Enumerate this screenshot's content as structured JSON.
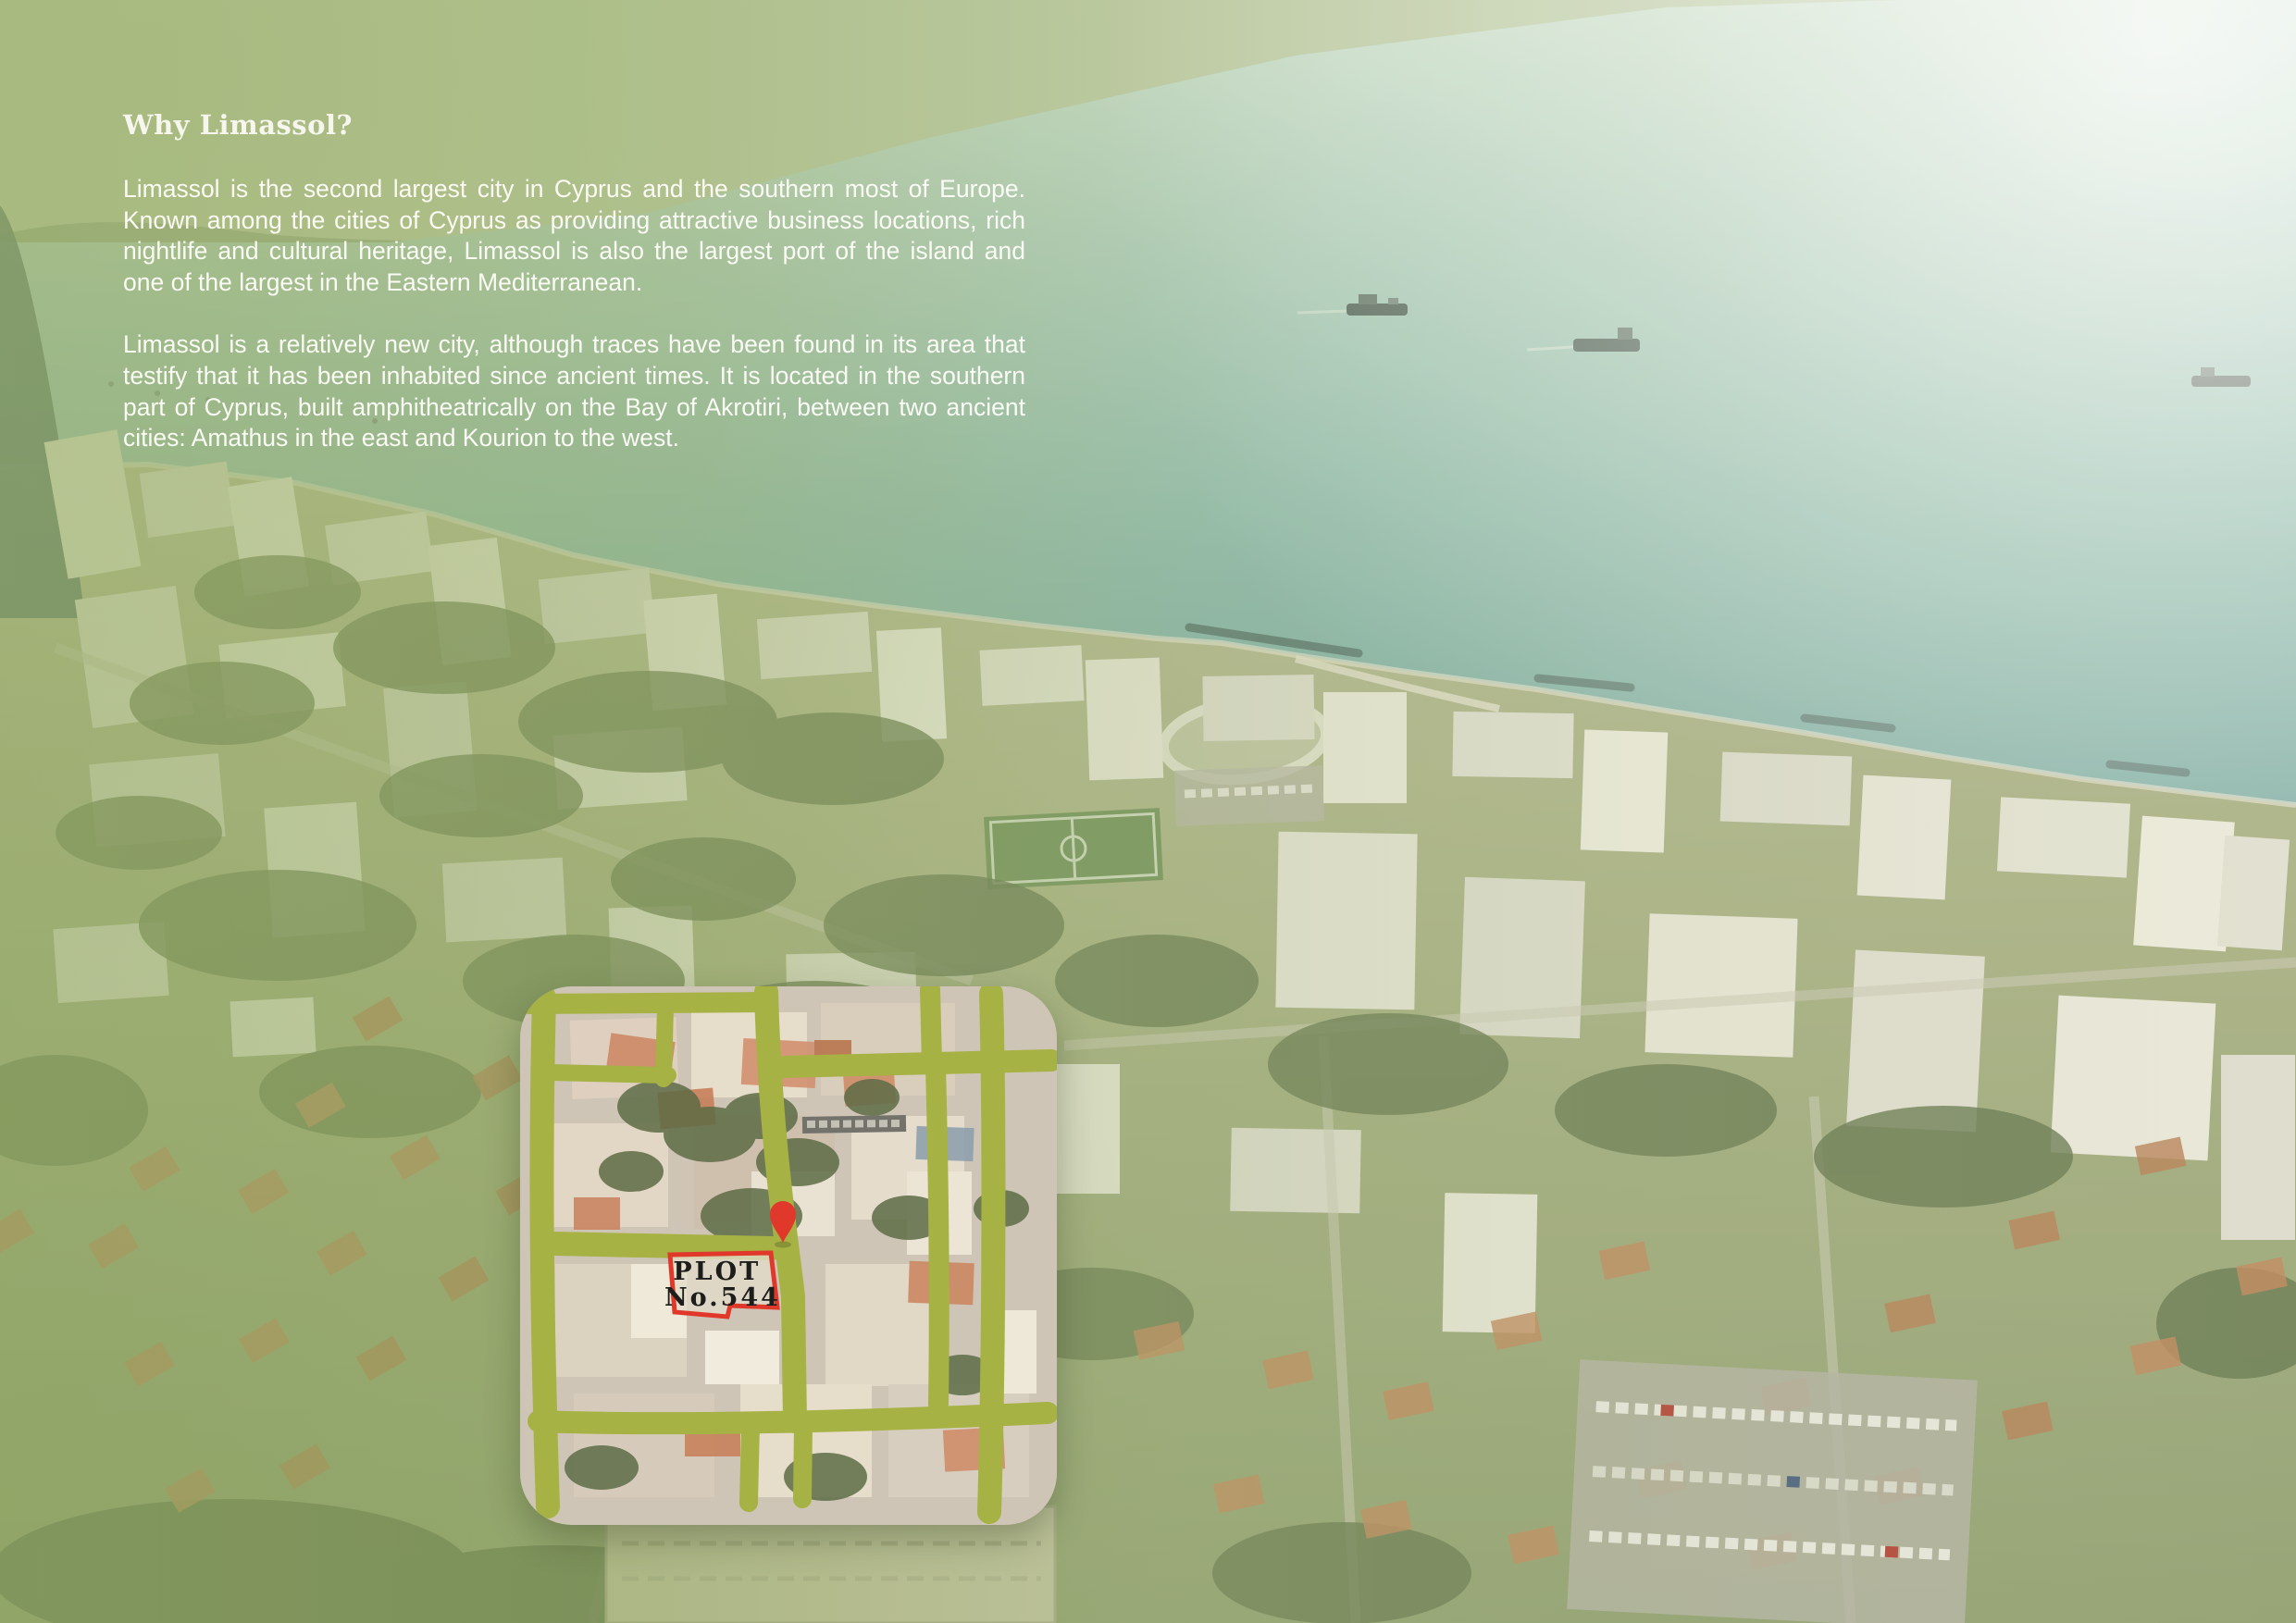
{
  "intro": {
    "heading": "Why Limassol?",
    "paragraph1": "Limassol is the second largest city in Cyprus and the southern most of Europe. Known among the cities of Cyprus as providing attractive business locations, rich nightlife and cultural heritage, Limassol is also the largest port of the island and one of the largest in the Eastern Mediterranean.",
    "paragraph2": "Limassol is a relatively new city, although traces have been found in its area that testify that it has been inhabited since ancient times.  It is located in the southern part of Cyprus, built amphitheatrically on the Bay of Akrotiri, between two ancient cities: Amathus in the east and Kourion to the west."
  },
  "map_inset": {
    "plot_label": {
      "line1": "PLOT",
      "line2": "No.544"
    },
    "colors": {
      "road": "#a6b243",
      "plot_outline": "#e0392b",
      "pin": "#e0392b",
      "label_text": "#1d1d1b"
    }
  },
  "scene_colors": {
    "sea_deep": "#72a49c",
    "sea_light": "#dff0e8",
    "land_olive": "#a5ad7e",
    "overlay_green": "#8ba457",
    "text_white": "#fbfbf4"
  }
}
